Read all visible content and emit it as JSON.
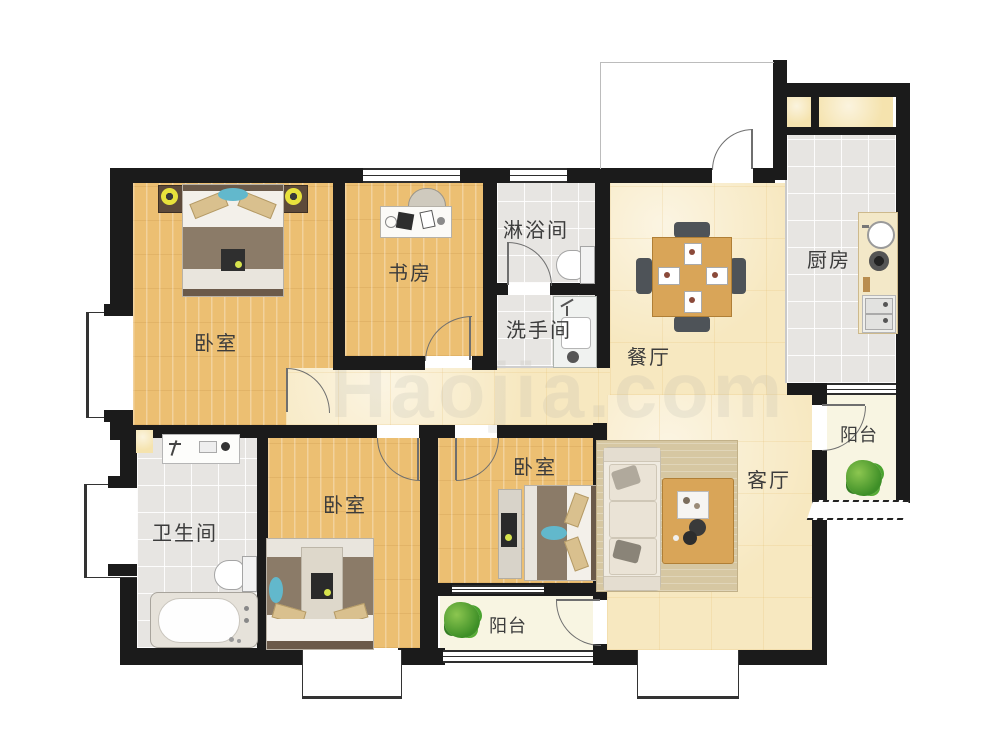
{
  "watermark": "Haojia.com",
  "rooms": [
    {
      "id": "bedroom-1",
      "label": "卧室"
    },
    {
      "id": "study",
      "label": "书房"
    },
    {
      "id": "shower-room",
      "label": "淋浴间"
    },
    {
      "id": "washroom",
      "label": "洗手间"
    },
    {
      "id": "dining-room",
      "label": "餐厅"
    },
    {
      "id": "kitchen",
      "label": "厨房"
    },
    {
      "id": "balcony-right",
      "label": "阳台"
    },
    {
      "id": "living-room",
      "label": "客厅"
    },
    {
      "id": "bathroom",
      "label": "卫生间"
    },
    {
      "id": "bedroom-2",
      "label": "卧室"
    },
    {
      "id": "bedroom-3",
      "label": "卧室"
    },
    {
      "id": "balcony-bottom",
      "label": "阳台"
    }
  ],
  "colors": {
    "wall": "#1b1b1b",
    "wood-floor": "#ecbf72",
    "marble-floor": "#f7e8c0",
    "tile-floor": "#e7e5e2",
    "balcony-floor": "#f8f5e2",
    "bed-duvet": "#8b7b68",
    "table-wood": "#d9a558",
    "accent-green": "#4f9e33",
    "label-text": "#3c3c3c"
  }
}
